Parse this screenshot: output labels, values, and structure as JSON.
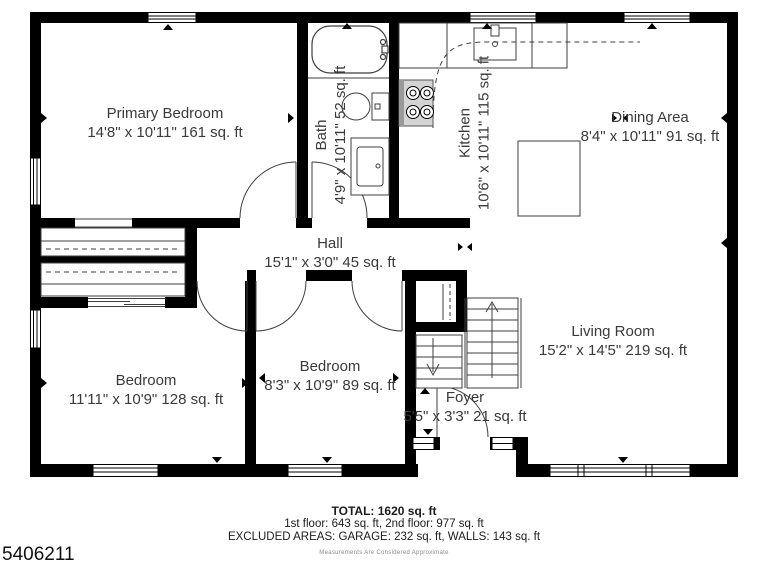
{
  "plan": {
    "rooms": [
      {
        "name": "Primary Bedroom",
        "dims": "14'8\" x 10'11\" 161 sq. ft"
      },
      {
        "name": "Bath",
        "dims": "4'9\" x 10'11\" 52 sq. ft"
      },
      {
        "name": "Kitchen",
        "dims": "10'6\" x 10'11\" 115 sq. ft"
      },
      {
        "name": "Dining Area",
        "dims": "8'4\" x 10'11\" 91 sq. ft"
      },
      {
        "name": "Hall",
        "dims": "15'1\" x 3'0\" 45 sq. ft"
      },
      {
        "name": "Bedroom",
        "dims": "11'11\" x 10'9\" 128 sq. ft"
      },
      {
        "name": "Bedroom",
        "dims": "8'3\" x 10'9\" 89 sq. ft"
      },
      {
        "name": "Foyer",
        "dims": "5'5\" x 3'3\" 21 sq. ft"
      },
      {
        "name": "Living Room",
        "dims": "15'2\" x 14'5\" 219 sq. ft"
      }
    ],
    "footer": {
      "total": "TOTAL: 1620 sq. ft",
      "floors": "1st floor: 643 sq. ft, 2nd floor: 977 sq. ft",
      "excluded": "EXCLUDED AREAS: GARAGE: 232 sq. ft, WALLS: 143 sq. ft",
      "disclaimer": "Measurements Are Considered Approximate"
    },
    "listing_id": "5406211",
    "colors": {
      "wall": "#000000",
      "fixture_line": "#3f3f3f",
      "text": "#3a3a3a",
      "disclaimer": "#8a8a8a"
    }
  }
}
